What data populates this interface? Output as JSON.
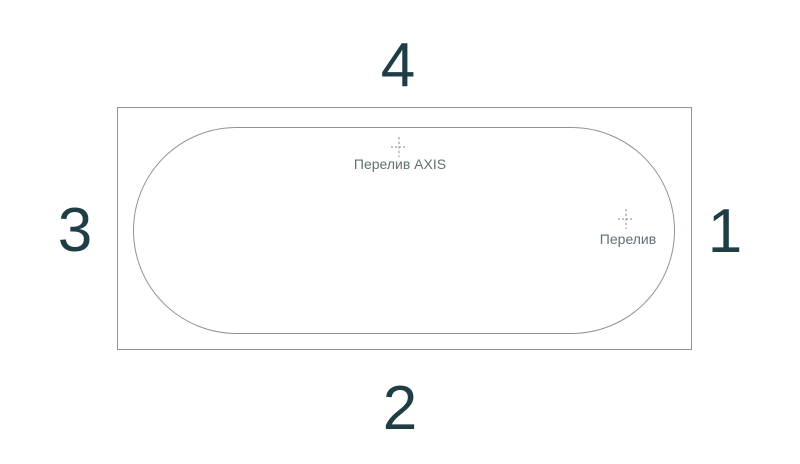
{
  "diagram": {
    "name": "bathtub-top-view-scheme"
  },
  "sides": {
    "top": "4",
    "right": "1",
    "bottom": "2",
    "left": "3"
  },
  "markers": [
    {
      "name": "overflow-axis",
      "label": "Перелив AXIS"
    },
    {
      "name": "overflow",
      "label": "Перелив"
    }
  ],
  "colors": {
    "line": "#8c9697",
    "number": "#1e3d45",
    "label": "#5f7173",
    "marker": "#98a2a3",
    "background": "#ffffff"
  }
}
